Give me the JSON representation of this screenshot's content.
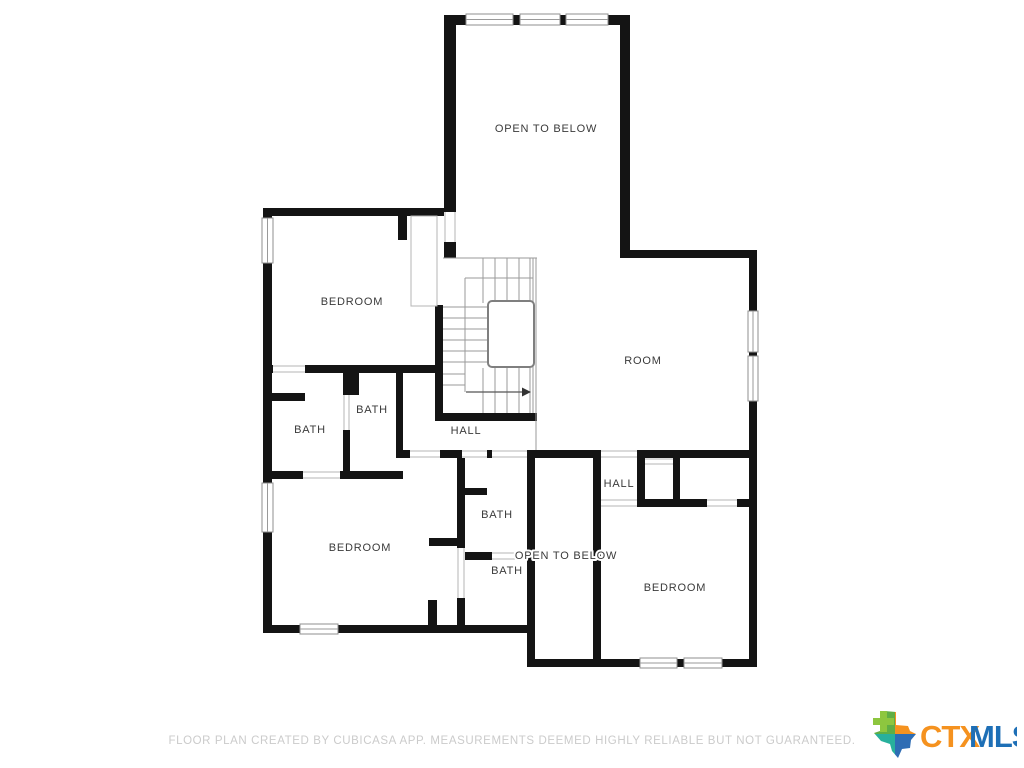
{
  "rooms": [
    {
      "id": "open-to-below-top",
      "label": "OPEN TO BELOW"
    },
    {
      "id": "bedroom-top-left",
      "label": "BEDROOM"
    },
    {
      "id": "room-right",
      "label": "ROOM"
    },
    {
      "id": "bath-inner",
      "label": "BATH"
    },
    {
      "id": "bath-left",
      "label": "BATH"
    },
    {
      "id": "hall-center",
      "label": "HALL"
    },
    {
      "id": "bedroom-bottom-left",
      "label": "BEDROOM"
    },
    {
      "id": "bath-center-upper",
      "label": "BATH"
    },
    {
      "id": "bath-center-lower",
      "label": "BATH"
    },
    {
      "id": "open-to-below-bottom",
      "label": "OPEN TO BELOW"
    },
    {
      "id": "hall-right",
      "label": "HALL"
    },
    {
      "id": "bedroom-bottom-right",
      "label": "BEDROOM"
    }
  ],
  "footer": {
    "disclaimer": "FLOOR PLAN CREATED BY CUBICASA APP. MEASUREMENTS DEEMED HIGHLY RELIABLE BUT NOT GUARANTEED."
  },
  "branding": {
    "logo_ctx": "CTX",
    "logo_mls": "MLS",
    "ctx_color": "#F5921F",
    "mls_color": "#1E6FB6",
    "texas_top_left_color": "#5FAE45",
    "texas_top_right_color": "#F5921F",
    "texas_bottom_left_color": "#28B09C",
    "texas_bottom_right_color": "#2E6DB4",
    "plus_color": "#8DC63F"
  }
}
